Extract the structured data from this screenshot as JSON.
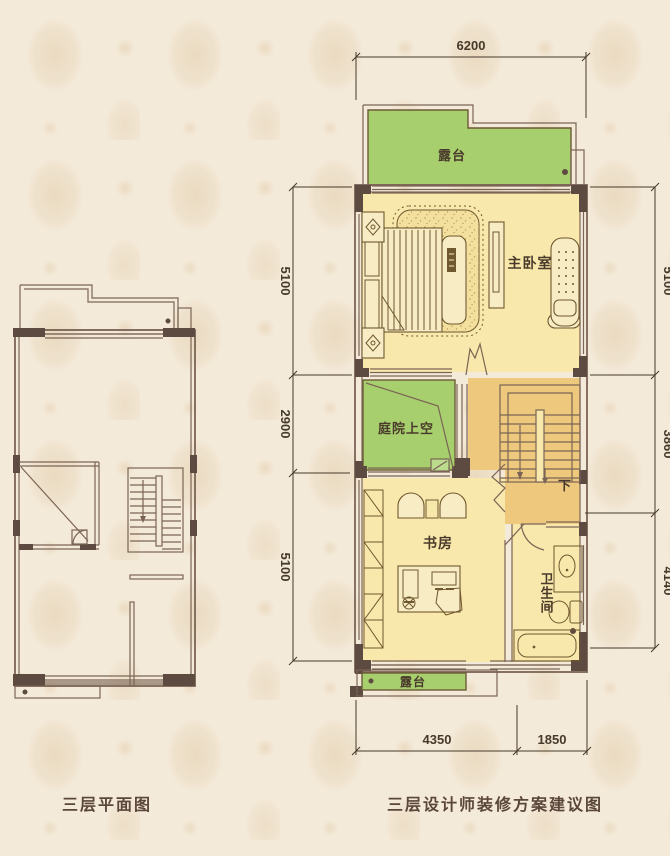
{
  "colors": {
    "background": "#f4ead9",
    "wall_dark": "#5d4a40",
    "line_brown": "#7b6455",
    "green": "#a7cf6e",
    "green_light": "#bcdb8e",
    "green_stroke": "#6d5b37",
    "yellow": "#f9e8ab",
    "orange": "#eec87d",
    "furniture_fill": "#f7ecc4",
    "furniture_stroke": "#70582f",
    "rug_fill": "#f4e09e",
    "dim_color": "#463a2b",
    "label_color": "#4a3a2b",
    "caption_color": "#5a463a"
  },
  "captions": {
    "left": "三层平面图",
    "right": "三层设计师装修方案建议图"
  },
  "right_plan": {
    "labels": {
      "terrace_top": "露台",
      "master_bedroom": "主卧室",
      "courtyard_void": "庭院上空",
      "study": "书房",
      "bathroom": "卫生间",
      "stair_down": "下",
      "terrace_bottom": "露台"
    },
    "dims": {
      "top_width": "6200",
      "left": [
        "5100",
        "2900",
        "5100"
      ],
      "right": [
        "5100",
        "3860",
        "4140"
      ],
      "bottom": [
        "4350",
        "1850"
      ]
    }
  }
}
